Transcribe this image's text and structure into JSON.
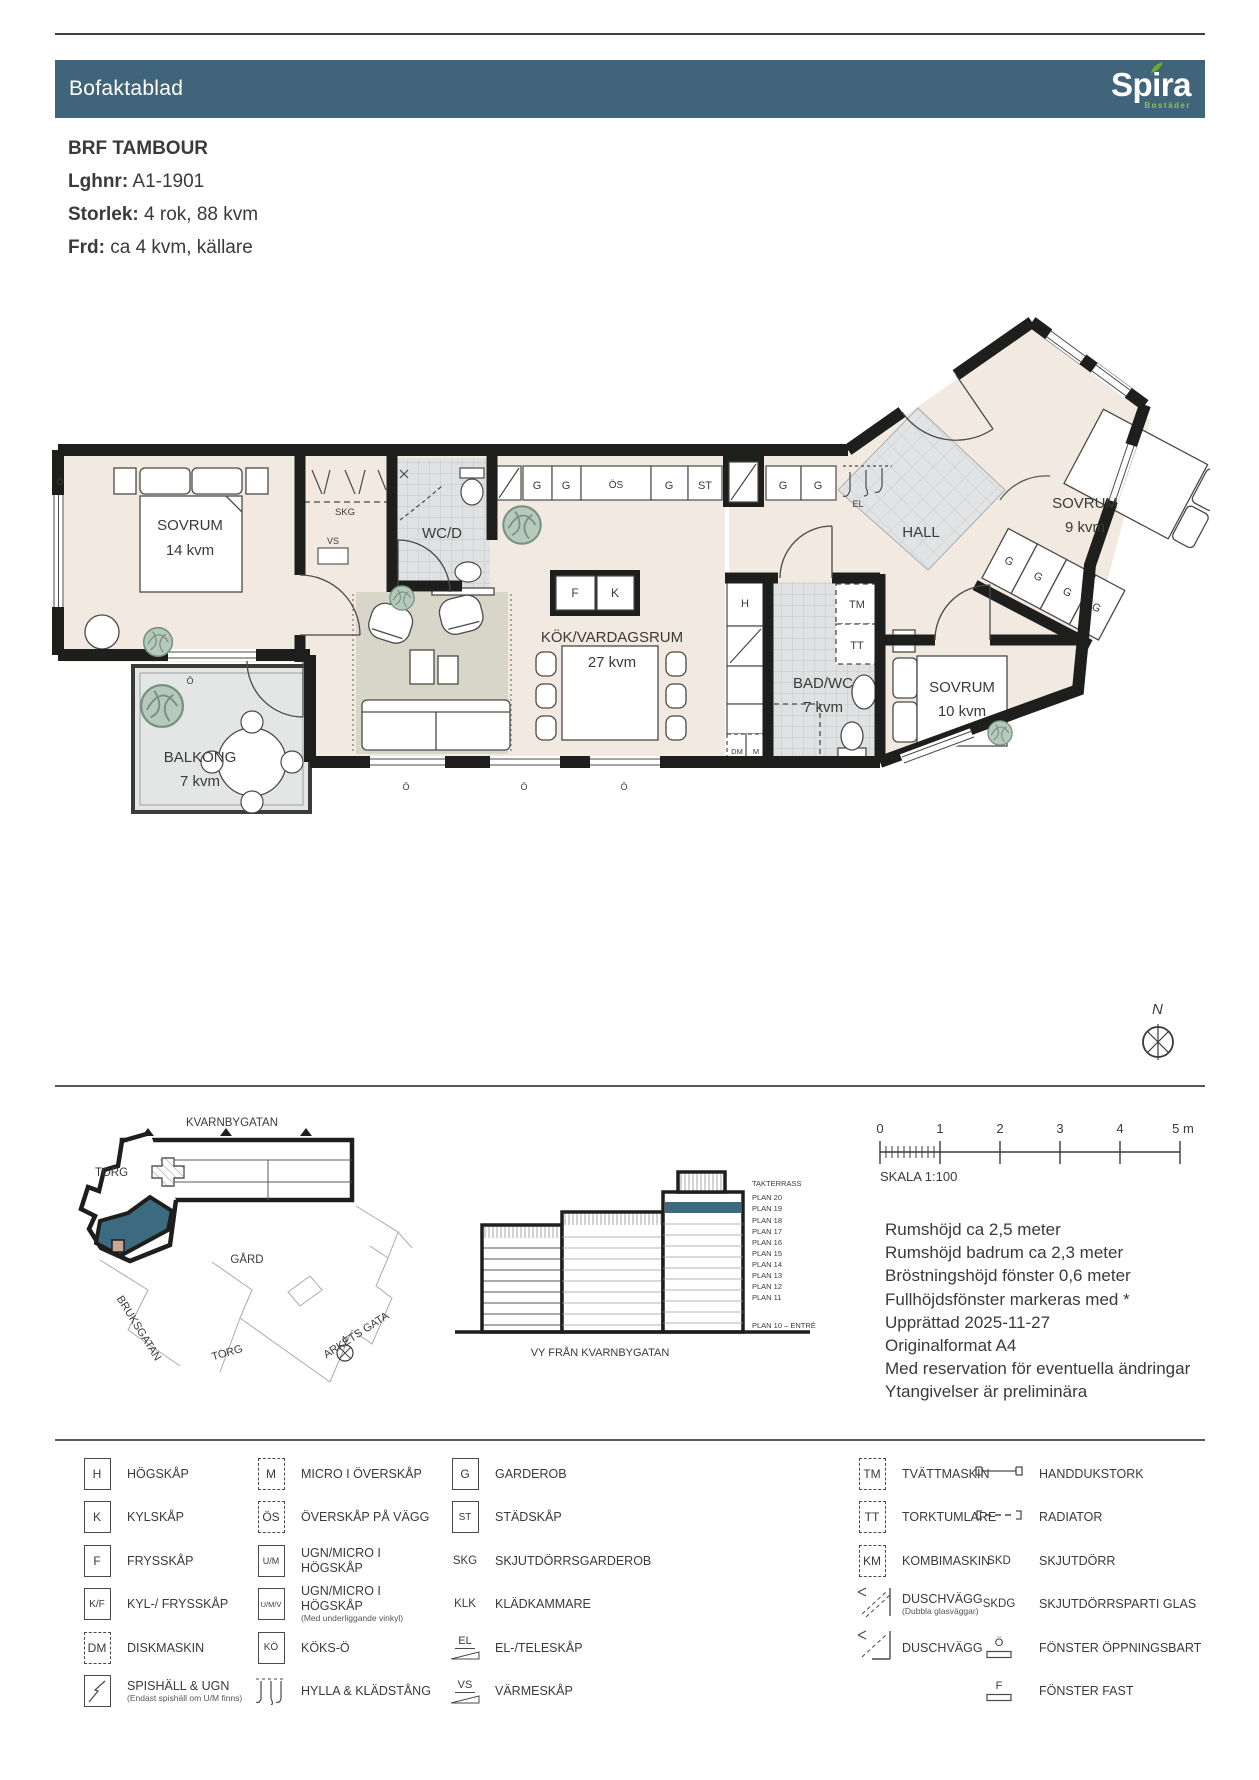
{
  "header": {
    "title": "Bofaktablad",
    "brand": "Spira",
    "brand_sub": "Bostäder",
    "bar_color": "#40657a",
    "accent_green": "#6fae28"
  },
  "info": {
    "project": "BRF TAMBOUR",
    "rows": [
      {
        "label": "Lghnr:",
        "value": "A1-1901"
      },
      {
        "label": "Storlek:",
        "value": "4 rok, 88 kvm"
      },
      {
        "label": "Frd:",
        "value": "ca 4 kvm, källare"
      }
    ]
  },
  "plan": {
    "rooms": [
      {
        "name": "SOVRUM",
        "area": "14 kvm"
      },
      {
        "name": "WC/D",
        "area": ""
      },
      {
        "name": "KÖK/VARDAGSRUM",
        "area": "27 kvm"
      },
      {
        "name": "HALL",
        "area": ""
      },
      {
        "name": "SOVRUM",
        "area": "9 kvm"
      },
      {
        "name": "BAD/WC",
        "area": "7 kvm"
      },
      {
        "name": "SOVRUM",
        "area": "10 kvm"
      },
      {
        "name": "BALKONG",
        "area": "7 kvm"
      }
    ],
    "tags": {
      "skg": "SKG",
      "vs": "VS",
      "el": "EL",
      "g": "G",
      "os": "ÖS",
      "st": "ST",
      "f": "F",
      "k": "K",
      "h": "H",
      "tm": "TM",
      "tt": "TT",
      "dm": "DM",
      "m": "M",
      "o": "Ö"
    },
    "compass": "N",
    "wall_color": "#1e1e1c",
    "room_color": "#f2e9e1",
    "highlight_color": "#3c6a81"
  },
  "siteplan": {
    "street_top": "KVARNBYGATAN",
    "torg": "TORG",
    "gard": "GÅRD",
    "bruksgatan": "BRUKSGATAN",
    "arkets_gata": "ARKETS GATA",
    "torg2": "TORG",
    "north": "N"
  },
  "elevation": {
    "caption": "VY FRÅN KVARNBYGATAN",
    "floors": [
      "TAKTERRASS",
      "PLAN 20",
      "PLAN 19",
      "PLAN 18",
      "PLAN 17",
      "PLAN 16",
      "PLAN 15",
      "PLAN 14",
      "PLAN 13",
      "PLAN 12",
      "PLAN 11"
    ],
    "entry": "PLAN 10 – ENTRÉ",
    "highlight_floor": "PLAN 19",
    "highlight_color": "#3c6a81"
  },
  "scalebar": {
    "ticks": [
      "0",
      "1",
      "2",
      "3",
      "4",
      "5 m"
    ],
    "caption": "SKALA 1:100"
  },
  "notes": {
    "lines": [
      "Rumshöjd ca 2,5 meter",
      "Rumshöjd badrum ca 2,3 meter",
      "Bröstningshöjd fönster 0,6 meter",
      "Fullhöjdsfönster markeras med *",
      "Upprättad 2025-11-27",
      "Originalformat A4",
      "Med reservation för eventuella ändringar",
      "Ytangivelser är preliminära"
    ]
  },
  "legend": {
    "columns": [
      {
        "rows": [
          {
            "sym": "H",
            "label": "HÖGSKÅP",
            "sub": ""
          },
          {
            "sym": "K",
            "label": "KYLSKÅP",
            "sub": ""
          },
          {
            "sym": "F",
            "label": "FRYSSKÅP",
            "sub": ""
          },
          {
            "sym": "K/F",
            "label": "KYL-/ FRYSSKÅP",
            "sub": ""
          },
          {
            "sym": "DM",
            "label": "DISKMASKIN",
            "sub": ""
          },
          {
            "sym": "",
            "label": "SPISHÄLL & UGN",
            "sub": "(Endast spishäll om U/M finns)"
          }
        ]
      },
      {
        "rows": [
          {
            "sym": "M",
            "label": "MICRO I ÖVERSKÅP",
            "sub": ""
          },
          {
            "sym": "ÖS",
            "label": "ÖVERSKÅP PÅ VÄGG",
            "sub": ""
          },
          {
            "sym": "U/M",
            "label": "UGN/MICRO I HÖGSKÅP",
            "sub": ""
          },
          {
            "sym": "U/M/V",
            "label": "UGN/MICRO I HÖGSKÅP",
            "sub": "(Med underliggande vinkyl)"
          },
          {
            "sym": "KÖ",
            "label": "KÖKS-Ö",
            "sub": ""
          },
          {
            "sym": "",
            "label": "HYLLA & KLÄDSTÅNG",
            "sub": ""
          }
        ]
      },
      {
        "rows": [
          {
            "sym": "G",
            "label": "GARDEROB",
            "sub": ""
          },
          {
            "sym": "ST",
            "label": "STÄDSKÅP",
            "sub": ""
          },
          {
            "sym": "SKG",
            "label": "SKJUTDÖRRSGARDEROB",
            "sub": ""
          },
          {
            "sym": "KLK",
            "label": "KLÄDKAMMARE",
            "sub": ""
          },
          {
            "sym": "EL",
            "label": "EL-/TELESKÅP",
            "sub": ""
          },
          {
            "sym": "VS",
            "label": "VÄRMESKÅP",
            "sub": ""
          }
        ]
      },
      {
        "rows": [
          {
            "sym": "TM",
            "label": "TVÄTTMASKIN",
            "sub": ""
          },
          {
            "sym": "TT",
            "label": "TORKTUMLARE",
            "sub": ""
          },
          {
            "sym": "KM",
            "label": "KOMBIMASKIN",
            "sub": ""
          },
          {
            "sym": "",
            "label": "DUSCHVÄGG",
            "sub": "(Dubbla glasväggar)"
          },
          {
            "sym": "",
            "label": "DUSCHVÄGG",
            "sub": ""
          }
        ]
      },
      {
        "rows": [
          {
            "sym": "",
            "label": "HANDDUKSTORK",
            "sub": ""
          },
          {
            "sym": "",
            "label": "RADIATOR",
            "sub": ""
          },
          {
            "sym": "SKD",
            "label": "SKJUTDÖRR",
            "sub": ""
          },
          {
            "sym": "SKDG",
            "label": "SKJUTDÖRRSPARTI GLAS",
            "sub": ""
          },
          {
            "sym": "Ö",
            "label": "FÖNSTER ÖPPNINGSBART",
            "sub": ""
          },
          {
            "sym": "F",
            "label": "FÖNSTER FAST",
            "sub": ""
          }
        ]
      }
    ]
  }
}
